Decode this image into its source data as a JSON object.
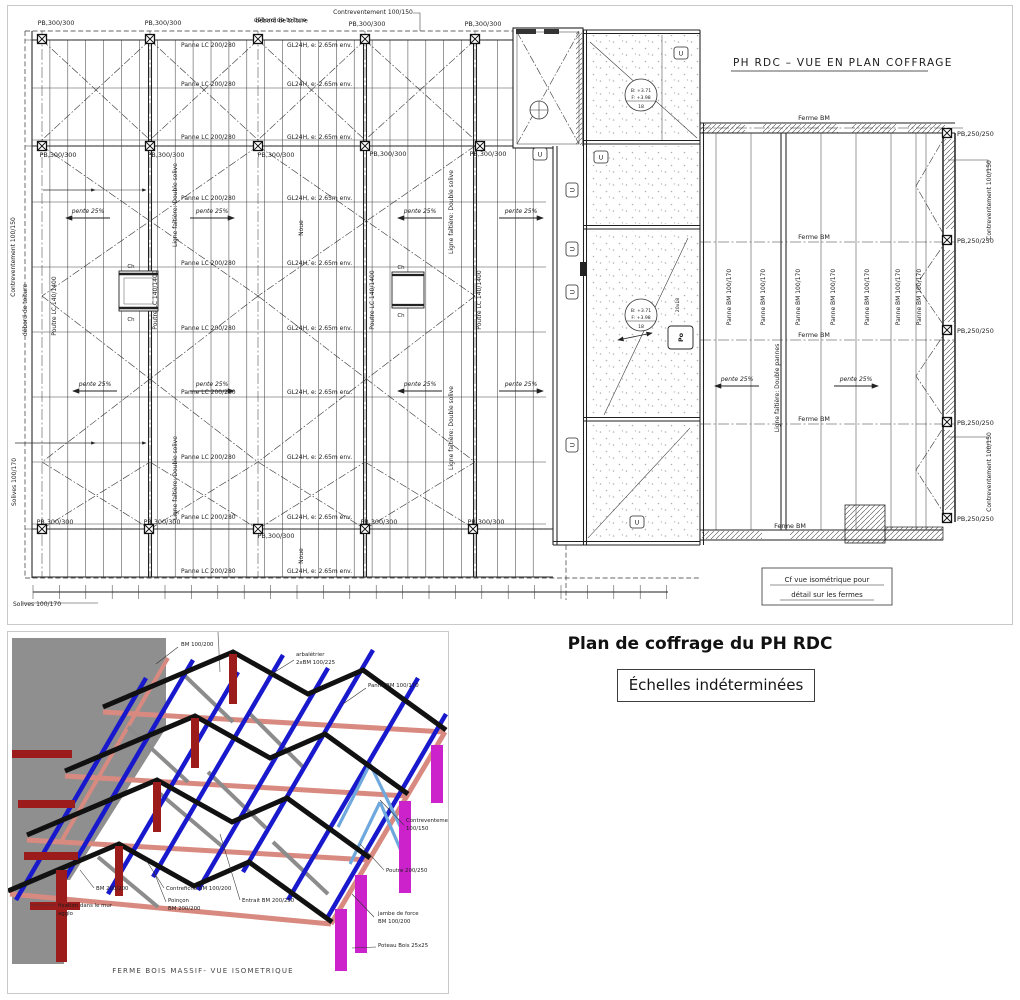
{
  "title_block": {
    "title": "Plan de coffrage du PH RDC",
    "scale_note": "Échelles indéterminées"
  },
  "plan": {
    "title": "PH RDC – VUE EN PLAN COFFRAGE",
    "labels": {
      "pb300": "PB,300/300",
      "pb250": "PB,250/250",
      "panne_lc": "Panne LC 200/280",
      "gl24h": "GL24H, e: 2.65m env.",
      "poutre_lc": "Poutre LC 140/1400",
      "panne_bm": "Panne BM 100/170",
      "ferme_bm": "Ferme BM",
      "contreventement": "Contreventement 100/150",
      "pente": "pente 25%",
      "faitiere_solive": "Ligne faîtière: Double solive",
      "faitiere_pannes": "Ligne faîtière: Double pannes",
      "noue": "Noue",
      "solives": "Solives 100/170",
      "debord": "débord de toiture",
      "ch": "Ch",
      "u_mark": "U",
      "po": "Po",
      "stair_steps": "20x18",
      "level_b": "B: +3.71",
      "level_f": "F: +3.98",
      "level_num": "18",
      "note_line1": "Cf vue isométrique pour",
      "note_line2": "détail sur les fermes"
    }
  },
  "iso": {
    "caption": "FERME BOIS MASSIF- VUE ISOMETRIQUE",
    "callouts": {
      "bm_100_200": "BM 100/200",
      "arbaletrier1": "arbalétrier",
      "arbaletrier2": "2xBM 100/225",
      "panne_bm": "Panne BM 100/170",
      "contreventement1": "Contreventement",
      "contreventement2": "100/150",
      "poutre": "Poutre 200/250",
      "bm_200_200": "BM 200/200",
      "fixation1": "fixation dans le mur",
      "fixation2": "agglo",
      "contrefiche": "Contrefiche BM 100/200",
      "poincon1": "Poinçon",
      "poincon2": "BM 200/200",
      "entrait": "Entrait BM 200/250",
      "jambe1": "jambe de force",
      "jambe2": "BM 100/200",
      "poteau": "Poteau Bois 25x25"
    },
    "colors": {
      "panne_blue": "#1818cc",
      "rafter_black": "#111111",
      "beam_salmon": "#d98a80",
      "post_magenta": "#cc22cc",
      "post_darkred": "#9c1c1c",
      "bracing_lightblue": "#6fa8dc",
      "wall_gray": "#8f8f8f"
    }
  }
}
